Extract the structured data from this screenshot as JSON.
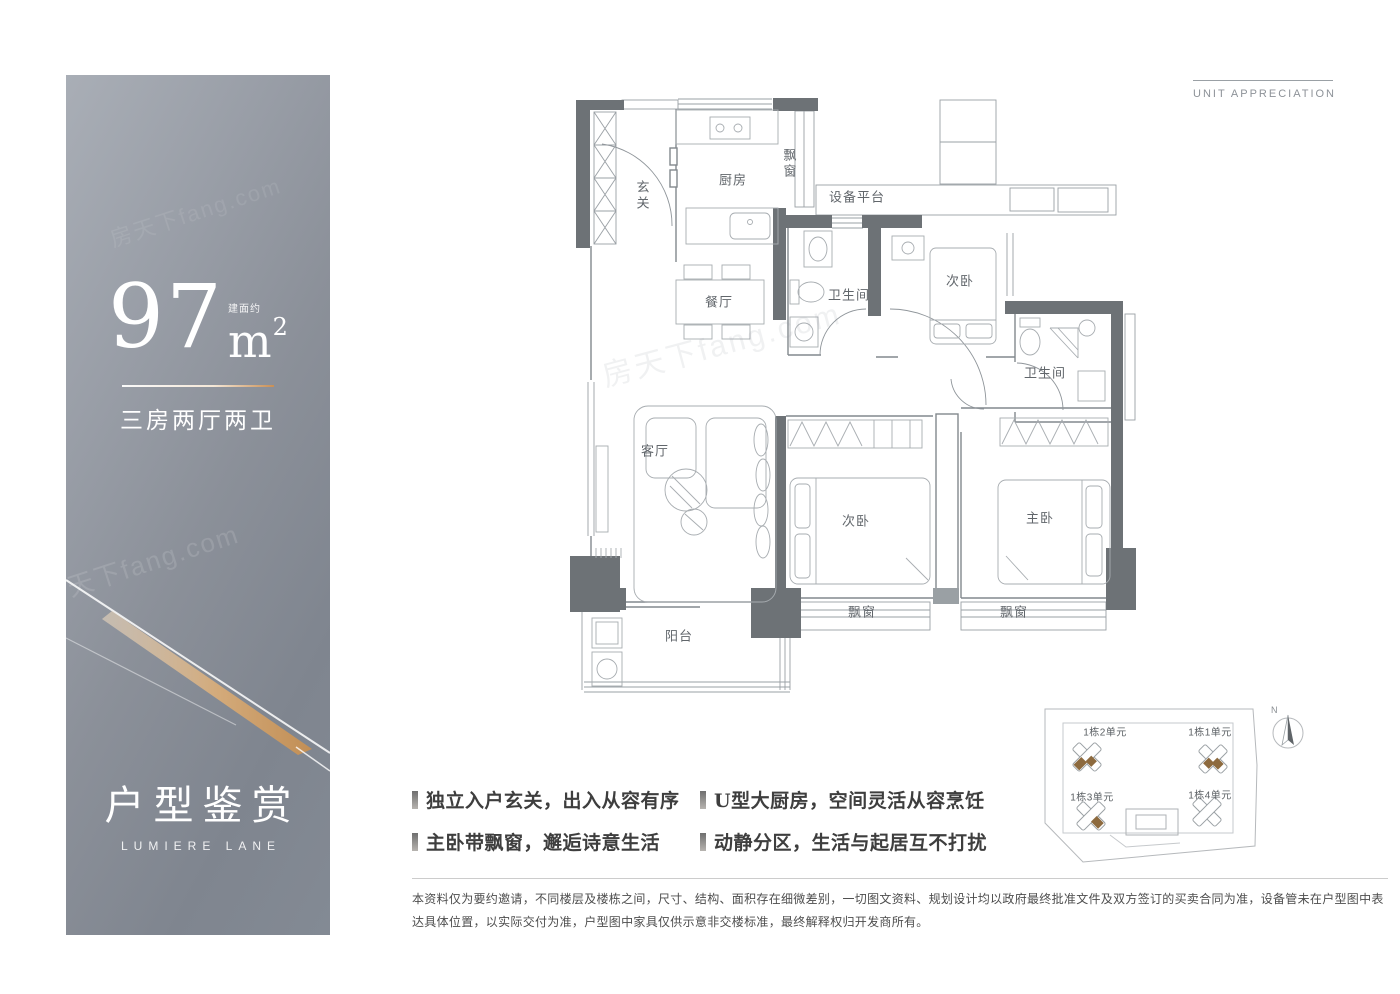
{
  "panel": {
    "area_prefix": "建面约",
    "area_value": "97",
    "area_unit": "m",
    "area_sup": "2",
    "layout": "三房两厅两卫",
    "title": "户型鉴赏",
    "subtitle": "LUMIERE LANE",
    "watermark": "房天下fang.com"
  },
  "header": {
    "caption": "UNIT APPRECIATION"
  },
  "floorplan": {
    "rooms": [
      {
        "label": "玄关"
      },
      {
        "label": "厨房"
      },
      {
        "label": "飘窗"
      },
      {
        "label": "设备平台"
      },
      {
        "label": "餐厅"
      },
      {
        "label": "卫生间"
      },
      {
        "label": "次卧"
      },
      {
        "label": "卫生间"
      },
      {
        "label": "客厅"
      },
      {
        "label": "次卧"
      },
      {
        "label": "主卧"
      },
      {
        "label": "阳台"
      },
      {
        "label": "飘窗"
      },
      {
        "label": "飘窗"
      }
    ]
  },
  "features": [
    "独立入户玄关，出入从容有序",
    "主卧带飘窗，邂逅诗意生活",
    "U型大厨房，空间灵活从容烹饪",
    "动静分区，生活与起居互不打扰"
  ],
  "siteplan": {
    "units": [
      "1栋2单元",
      "1栋1单元",
      "1栋3单元",
      "1栋4单元"
    ],
    "compass": "N"
  },
  "disclaimer": {
    "text": "本资料仅为要约邀请，不同楼层及楼栋之间，尺寸、结构、面积存在细微差别，一切图文资料、规划设计均以政府最终批准文件及双方签订的买卖合同为准，设备管未在户型图中表达具体位置，以实际交付为准，户型图中家具仅供示意非交楼标准，最终解释权归开发商所有。"
  },
  "colors": {
    "panel_light": "#a9aeb6",
    "panel_dark": "#7f858f",
    "gold_accent": "#c98f55",
    "wall": "#6d7276",
    "site_brown": "#8d6a3e"
  }
}
